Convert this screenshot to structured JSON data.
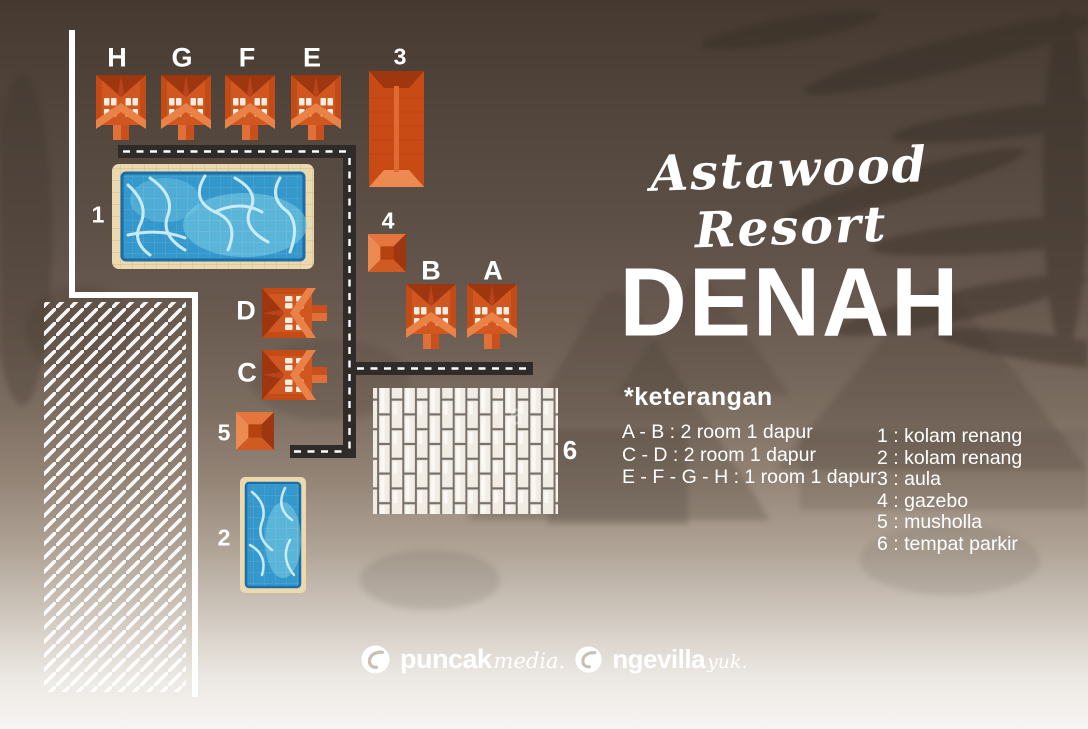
{
  "title": {
    "script": "Astawood Resort",
    "main": "DENAH"
  },
  "legend": {
    "heading": "*keterangan",
    "rooms": [
      "A - B : 2 room 1 dapur",
      "C - D : 2 room 1 dapur",
      "E - F - G - H : 1 room 1 dapur"
    ],
    "places": [
      "1 : kolam renang",
      "2 : kolam renang",
      "3 : aula",
      "4 : gazebo",
      "5 : musholla",
      "6 : tempat parkir"
    ]
  },
  "map": {
    "labels": {
      "h": "H",
      "g": "G",
      "f": "F",
      "e": "E",
      "n3": "3",
      "n1": "1",
      "n4": "4",
      "b": "B",
      "a": "A",
      "d": "D",
      "c": "C",
      "n5": "5",
      "n2": "2",
      "n6": "6",
      "n6_faint": "6"
    }
  },
  "footer": {
    "brand1_bold": "puncak",
    "brand1_script": "media.",
    "brand2_bold": "ngevilla",
    "brand2_script": "yuk."
  },
  "colors": {
    "house_orange": "#d0571f",
    "house_dark": "#9e3610",
    "house_light": "#ea8147",
    "house_window": "#f6ecdf",
    "road": "#2e2b28",
    "road_dash": "#ffffff",
    "pool_deck": "#ecd9ae",
    "pool_water": "#3598cc",
    "pool_edge": "#1c6da6",
    "pool_caustic": "#cfeff8",
    "brick": "#f1ede5",
    "brick_gap": "#77716a",
    "path_line": "#ffffff",
    "text": "#ffffff"
  }
}
